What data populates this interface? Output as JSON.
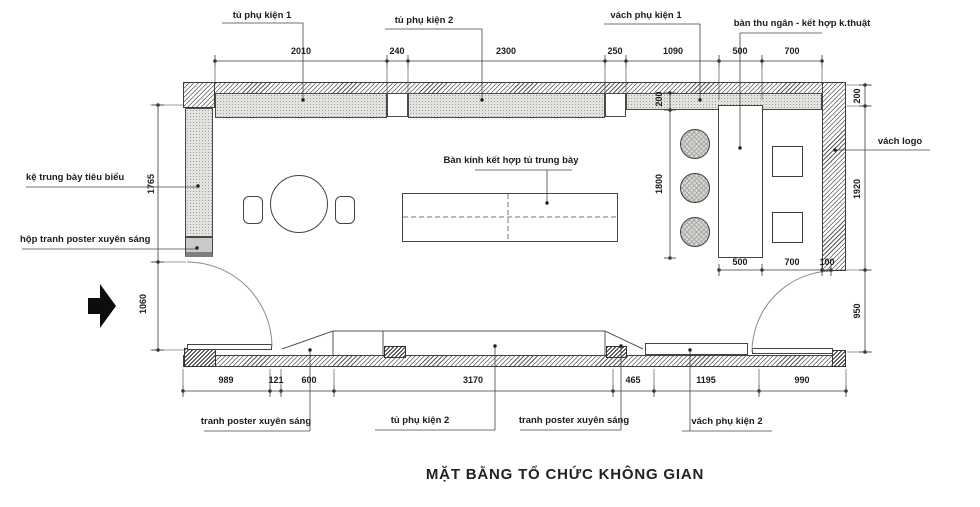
{
  "title": "MẶT BẰNG TỔ CHỨC KHÔNG GIAN",
  "callouts": {
    "top": [
      "tủ phụ kiện 1",
      "tủ phụ kiện 2",
      "vách phụ kiện 1",
      "bàn thu ngân - kết hợp k.thuật"
    ],
    "left": [
      "kệ trung bày tiêu biểu",
      "hộp tranh poster xuyên sáng"
    ],
    "right": [
      "vách logo"
    ],
    "center": [
      "Bàn kính kết hợp tủ trung bày"
    ],
    "bottom": [
      "tranh poster xuyên sáng",
      "tủ phụ kiện 2",
      "tranh poster xuyên sáng",
      "vách phụ kiện 2"
    ]
  },
  "dims": {
    "top": [
      "2010",
      "240",
      "2300",
      "250",
      "1090",
      "500",
      "700"
    ],
    "bottom": [
      "989",
      "121",
      "600",
      "3170",
      "465",
      "1195",
      "990"
    ],
    "left": [
      "1765",
      "1060"
    ],
    "right": [
      "200",
      "1920",
      "950"
    ],
    "inner_vertical": [
      "200",
      "1800"
    ],
    "inner_cashier": [
      "500",
      "700",
      "100"
    ]
  },
  "line_color": "#3a3a3a"
}
